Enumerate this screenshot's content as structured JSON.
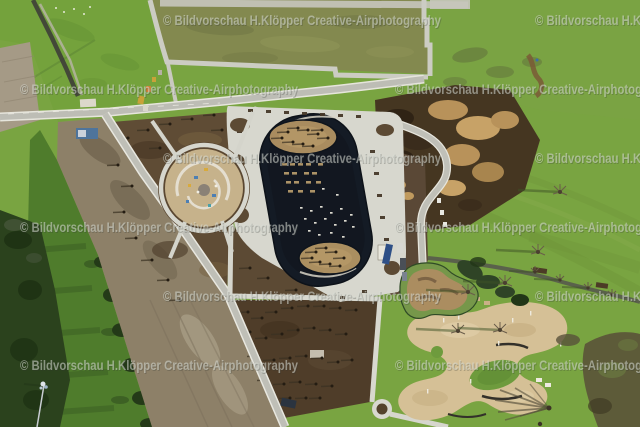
{
  "alt_text": "Aerial photograph of a park under construction with oval boating lake, playground, planting beds and sand play area",
  "watermark": {
    "text": "© Bildvorschau  H.Klöpper Creative-Airphotography",
    "font_size": 13.5,
    "text_length": 278,
    "color": "#d8dcd6",
    "opacity": 0.55,
    "shadow_color": "#2e332e",
    "shadow_opacity": 0.25,
    "rows": [
      {
        "y": 20,
        "xs": [
          163,
          535
        ]
      },
      {
        "y": 89,
        "xs": [
          20,
          395
        ]
      },
      {
        "y": 158,
        "xs": [
          163,
          535
        ]
      },
      {
        "y": 227,
        "xs": [
          20,
          395
        ]
      },
      {
        "y": 296,
        "xs": [
          163,
          535
        ]
      },
      {
        "y": 365,
        "xs": [
          20,
          395
        ]
      }
    ]
  },
  "palette": {
    "grass": "#79a441",
    "grass_dark": "#5d8a33",
    "olive_field": "#83894f",
    "path_light": "#d6d6cd",
    "road_gray": "#bdbdb5",
    "asphalt_dark": "#55564e",
    "soil_dark": "#4f3d29",
    "soil_brown": "#5f4c35",
    "dirt_pale": "#8d8068",
    "dirt_heap_tan": "#b8925a",
    "water": "#141b25",
    "island_sand": "#a98c5f",
    "sand_area": "#d5c096",
    "woods": "#2b421d"
  },
  "scene_labels": {
    "lake": "oval boating lake with two planted islands",
    "playground": "circular playground under construction",
    "sand": "organic shaped sand play area",
    "bmx": "dirt mound bike track",
    "beds": "planting beds with young trees"
  },
  "decorations": [
    {
      "target": "nw-bed-trees",
      "el": "use",
      "href": "#tsm",
      "points": [
        [
          128,
          138
        ],
        [
          148,
          130
        ],
        [
          170,
          124
        ],
        [
          192,
          119
        ],
        [
          214,
          115
        ],
        [
          118,
          165
        ],
        [
          132,
          186
        ],
        [
          124,
          212
        ],
        [
          136,
          238
        ],
        [
          152,
          260
        ],
        [
          168,
          280
        ],
        [
          222,
          130
        ],
        [
          240,
          125
        ],
        [
          236,
          150
        ],
        [
          160,
          148
        ],
        [
          180,
          300
        ]
      ]
    },
    {
      "target": "south-bed-trees",
      "el": "use",
      "href": "#tsm",
      "points": [
        [
          248,
          312
        ],
        [
          262,
          318
        ],
        [
          276,
          312
        ],
        [
          292,
          308
        ],
        [
          308,
          306
        ],
        [
          324,
          306
        ],
        [
          340,
          308
        ],
        [
          356,
          310
        ],
        [
          250,
          332
        ],
        [
          266,
          338
        ],
        [
          282,
          334
        ],
        [
          298,
          330
        ],
        [
          314,
          328
        ],
        [
          330,
          330
        ],
        [
          346,
          334
        ],
        [
          258,
          356
        ],
        [
          274,
          360
        ],
        [
          290,
          358
        ],
        [
          306,
          356
        ],
        [
          322,
          358
        ],
        [
          338,
          362
        ],
        [
          352,
          360
        ],
        [
          268,
          380
        ],
        [
          284,
          384
        ],
        [
          300,
          382
        ],
        [
          316,
          384
        ],
        [
          332,
          386
        ],
        [
          290,
          398
        ],
        [
          306,
          398
        ],
        [
          320,
          398
        ]
      ]
    },
    {
      "target": "sw-gap-trees",
      "el": "use",
      "href": "#tsm",
      "points": [
        [
          250,
          268
        ],
        [
          268,
          278
        ],
        [
          296,
          290
        ],
        [
          318,
          296
        ]
      ]
    },
    {
      "target": "west-strip-trees",
      "el": "use",
      "href": "#tsm",
      "points": [
        [
          78,
          140
        ],
        [
          96,
          150
        ],
        [
          112,
          162
        ],
        [
          90,
          180
        ],
        [
          108,
          196
        ],
        [
          126,
          210
        ],
        [
          102,
          228
        ],
        [
          120,
          246
        ],
        [
          138,
          262
        ],
        [
          150,
          286
        ],
        [
          164,
          306
        ],
        [
          178,
          330
        ]
      ]
    },
    {
      "target": "green-strip-trees",
      "el": "use",
      "href": "#tsg",
      "points": [
        [
          52,
          210
        ],
        [
          64,
          238
        ],
        [
          58,
          268
        ],
        [
          72,
          292
        ],
        [
          66,
          320
        ],
        [
          80,
          344
        ],
        [
          74,
          372
        ],
        [
          88,
          396
        ],
        [
          82,
          420
        ],
        [
          96,
          416
        ],
        [
          44,
          300
        ],
        [
          50,
          340
        ]
      ]
    },
    {
      "target": "north-island-trees",
      "el": "use",
      "href": "#tsm",
      "points": [
        [
          288,
          132
        ],
        [
          298,
          128
        ],
        [
          308,
          130
        ],
        [
          318,
          134
        ],
        [
          328,
          138
        ],
        [
          293,
          142
        ],
        [
          303,
          144
        ],
        [
          313,
          146
        ],
        [
          282,
          138
        ],
        [
          322,
          130
        ]
      ]
    },
    {
      "target": "south-island-trees",
      "el": "use",
      "href": "#tsm",
      "points": [
        [
          316,
          252
        ],
        [
          326,
          248
        ],
        [
          336,
          252
        ],
        [
          344,
          258
        ],
        [
          320,
          262
        ],
        [
          330,
          264
        ],
        [
          340,
          266
        ],
        [
          312,
          258
        ]
      ]
    },
    {
      "target": "marina-pontoons",
      "el": "rect",
      "w": 5,
      "h": 2.6,
      "fill": "#b59a6c",
      "opacity": 0.95,
      "points": [
        [
          282,
          163
        ],
        [
          290,
          163
        ],
        [
          298,
          163
        ],
        [
          306,
          163
        ],
        [
          318,
          163
        ],
        [
          284,
          172
        ],
        [
          292,
          172
        ],
        [
          304,
          172
        ],
        [
          312,
          172
        ],
        [
          286,
          181
        ],
        [
          294,
          181
        ],
        [
          306,
          181
        ],
        [
          316,
          181
        ],
        [
          288,
          190
        ],
        [
          298,
          190
        ],
        [
          310,
          190
        ]
      ]
    },
    {
      "target": "marina-boats",
      "el": "rect",
      "w": 2.6,
      "h": 1.7,
      "fill": "#e8e6da",
      "opacity": 0.95,
      "points": [
        [
          300,
          207
        ],
        [
          310,
          210
        ],
        [
          320,
          206
        ],
        [
          330,
          212
        ],
        [
          340,
          208
        ],
        [
          350,
          214
        ],
        [
          304,
          218
        ],
        [
          314,
          222
        ],
        [
          324,
          218
        ],
        [
          334,
          224
        ],
        [
          344,
          220
        ],
        [
          352,
          226
        ],
        [
          308,
          230
        ],
        [
          318,
          234
        ],
        [
          330,
          232
        ],
        [
          342,
          236
        ],
        [
          322,
          188
        ],
        [
          336,
          194
        ]
      ]
    },
    {
      "target": "sand-posts",
      "el": "rect",
      "w": 1.4,
      "h": 4.5,
      "fill": "#efece2",
      "opacity": 0.95,
      "points": [
        [
          443,
          318
        ],
        [
          458,
          315
        ],
        [
          512,
          318
        ],
        [
          530,
          311
        ],
        [
          498,
          341
        ],
        [
          560,
          342
        ],
        [
          470,
          379
        ],
        [
          427,
          389
        ],
        [
          516,
          300
        ]
      ]
    },
    {
      "target": "apron-planters",
      "el": "rect",
      "w": 5,
      "h": 3,
      "fill": "#463828",
      "opacity": 0.95,
      "points": [
        [
          248,
          109
        ],
        [
          266,
          110
        ],
        [
          284,
          111
        ],
        [
          302,
          112
        ],
        [
          320,
          113
        ],
        [
          338,
          114
        ],
        [
          356,
          115
        ],
        [
          237,
          130
        ],
        [
          234,
          155
        ],
        [
          233,
          180
        ],
        [
          233,
          205
        ],
        [
          370,
          150
        ],
        [
          374,
          172
        ],
        [
          377,
          194
        ],
        [
          380,
          216
        ],
        [
          384,
          238
        ],
        [
          362,
          290
        ],
        [
          340,
          296
        ]
      ]
    },
    {
      "target": "birds",
      "el": "circle",
      "r": 1,
      "fill": "#f2f2ea",
      "opacity": 0.9,
      "points": [
        [
          56,
          8
        ],
        [
          64,
          12
        ],
        [
          74,
          9
        ],
        [
          84,
          14
        ],
        [
          90,
          7
        ]
      ]
    }
  ]
}
